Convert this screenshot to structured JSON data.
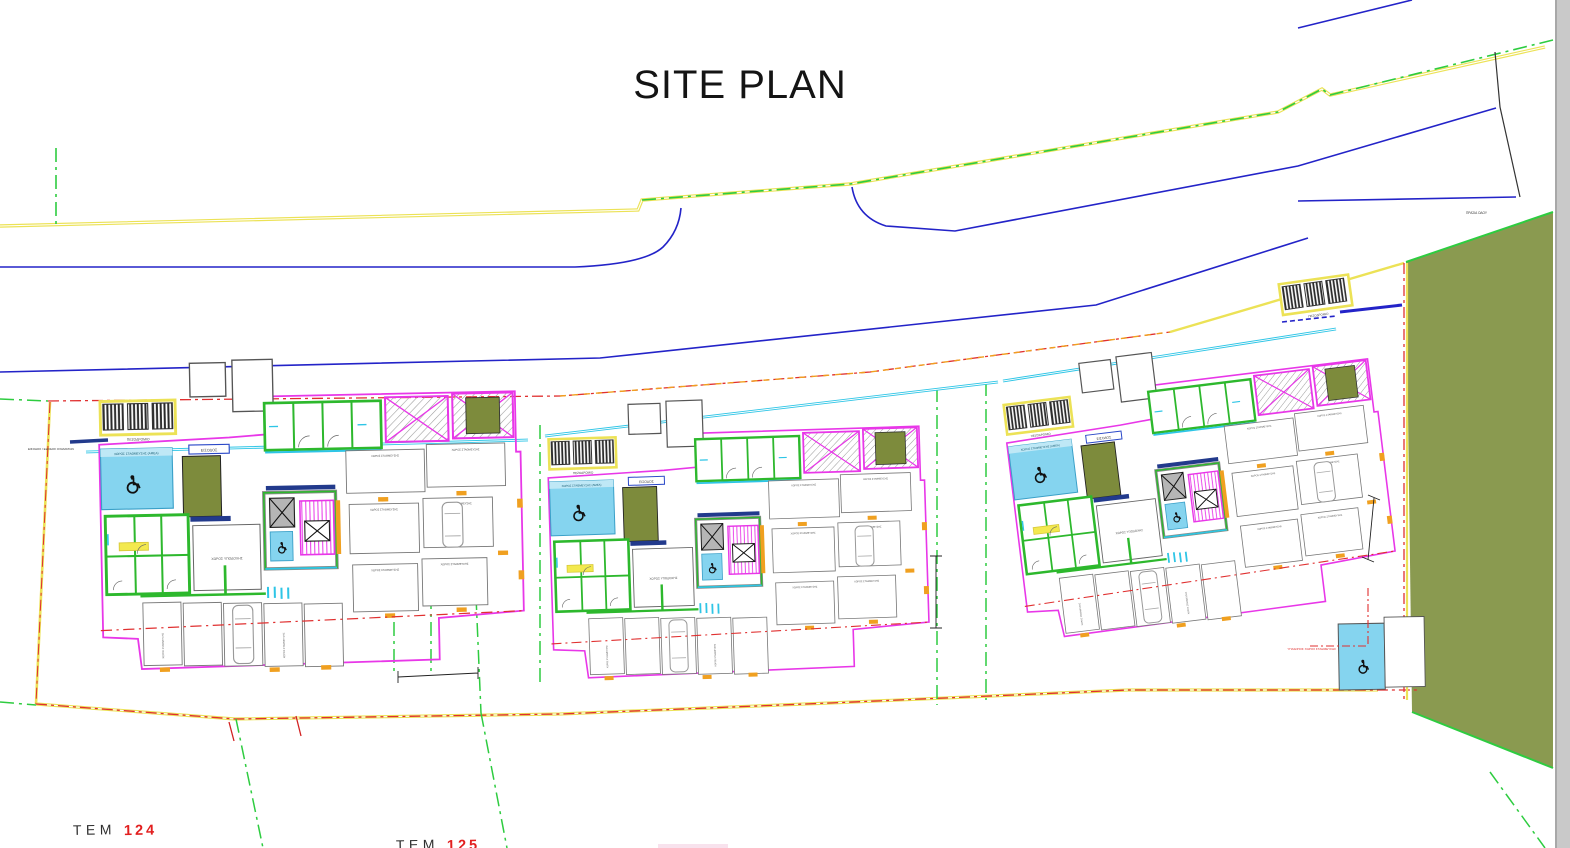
{
  "title": "SITE PLAN",
  "parcels": {
    "tem": "ΤΕΜ",
    "parcel_124": "124",
    "parcel_125": "125"
  },
  "micro_labels": {
    "vehicle_access": "ΕΙΣΟΔΟΣ / ΕΞΟΔΟΣ ΟΧΗΜΑΤΩΝ",
    "sidewalk": "ΠΕΖΟΔΡΟΜΙΟ",
    "parking_space": "ΧΩΡΟΣ ΣΤΑΘΜΕΥΣΗΣ",
    "accessible_parking": "ΧΩΡΟΣ ΣΤΑΘΜΕΥΣΗΣ (ΑΜΕΑ)",
    "reception": "ΧΩΡΟΣ ΥΠΟΔΟΧΗΣ",
    "entrance": "ΕΙΣΟΔΟΣ",
    "open_air_parking": "ΥΠΑΙΘΡΙΟΣ ΧΩΡΟΣ ΣΤΑΘΜΕΥΣΗΣ",
    "roadside_strip": "ΠΡΑΣΙΑ ΟΔΟΥ"
  },
  "colors": {
    "boundary_green": "#2ecc40",
    "road_blue": "#2323c8",
    "kerb_yellow": "#ece256",
    "building_magenta": "#e837e8",
    "wall_green": "#2db82d",
    "water_cyan": "#2ec5e6",
    "site_red": "#e03030",
    "landscape_olive": "#8a9a50",
    "planter_olive": "#7d8b3c",
    "accessible_blue": "#85d4ef",
    "marker_orange": "#f0a020",
    "parcel_number_red": "#e21f1f"
  }
}
